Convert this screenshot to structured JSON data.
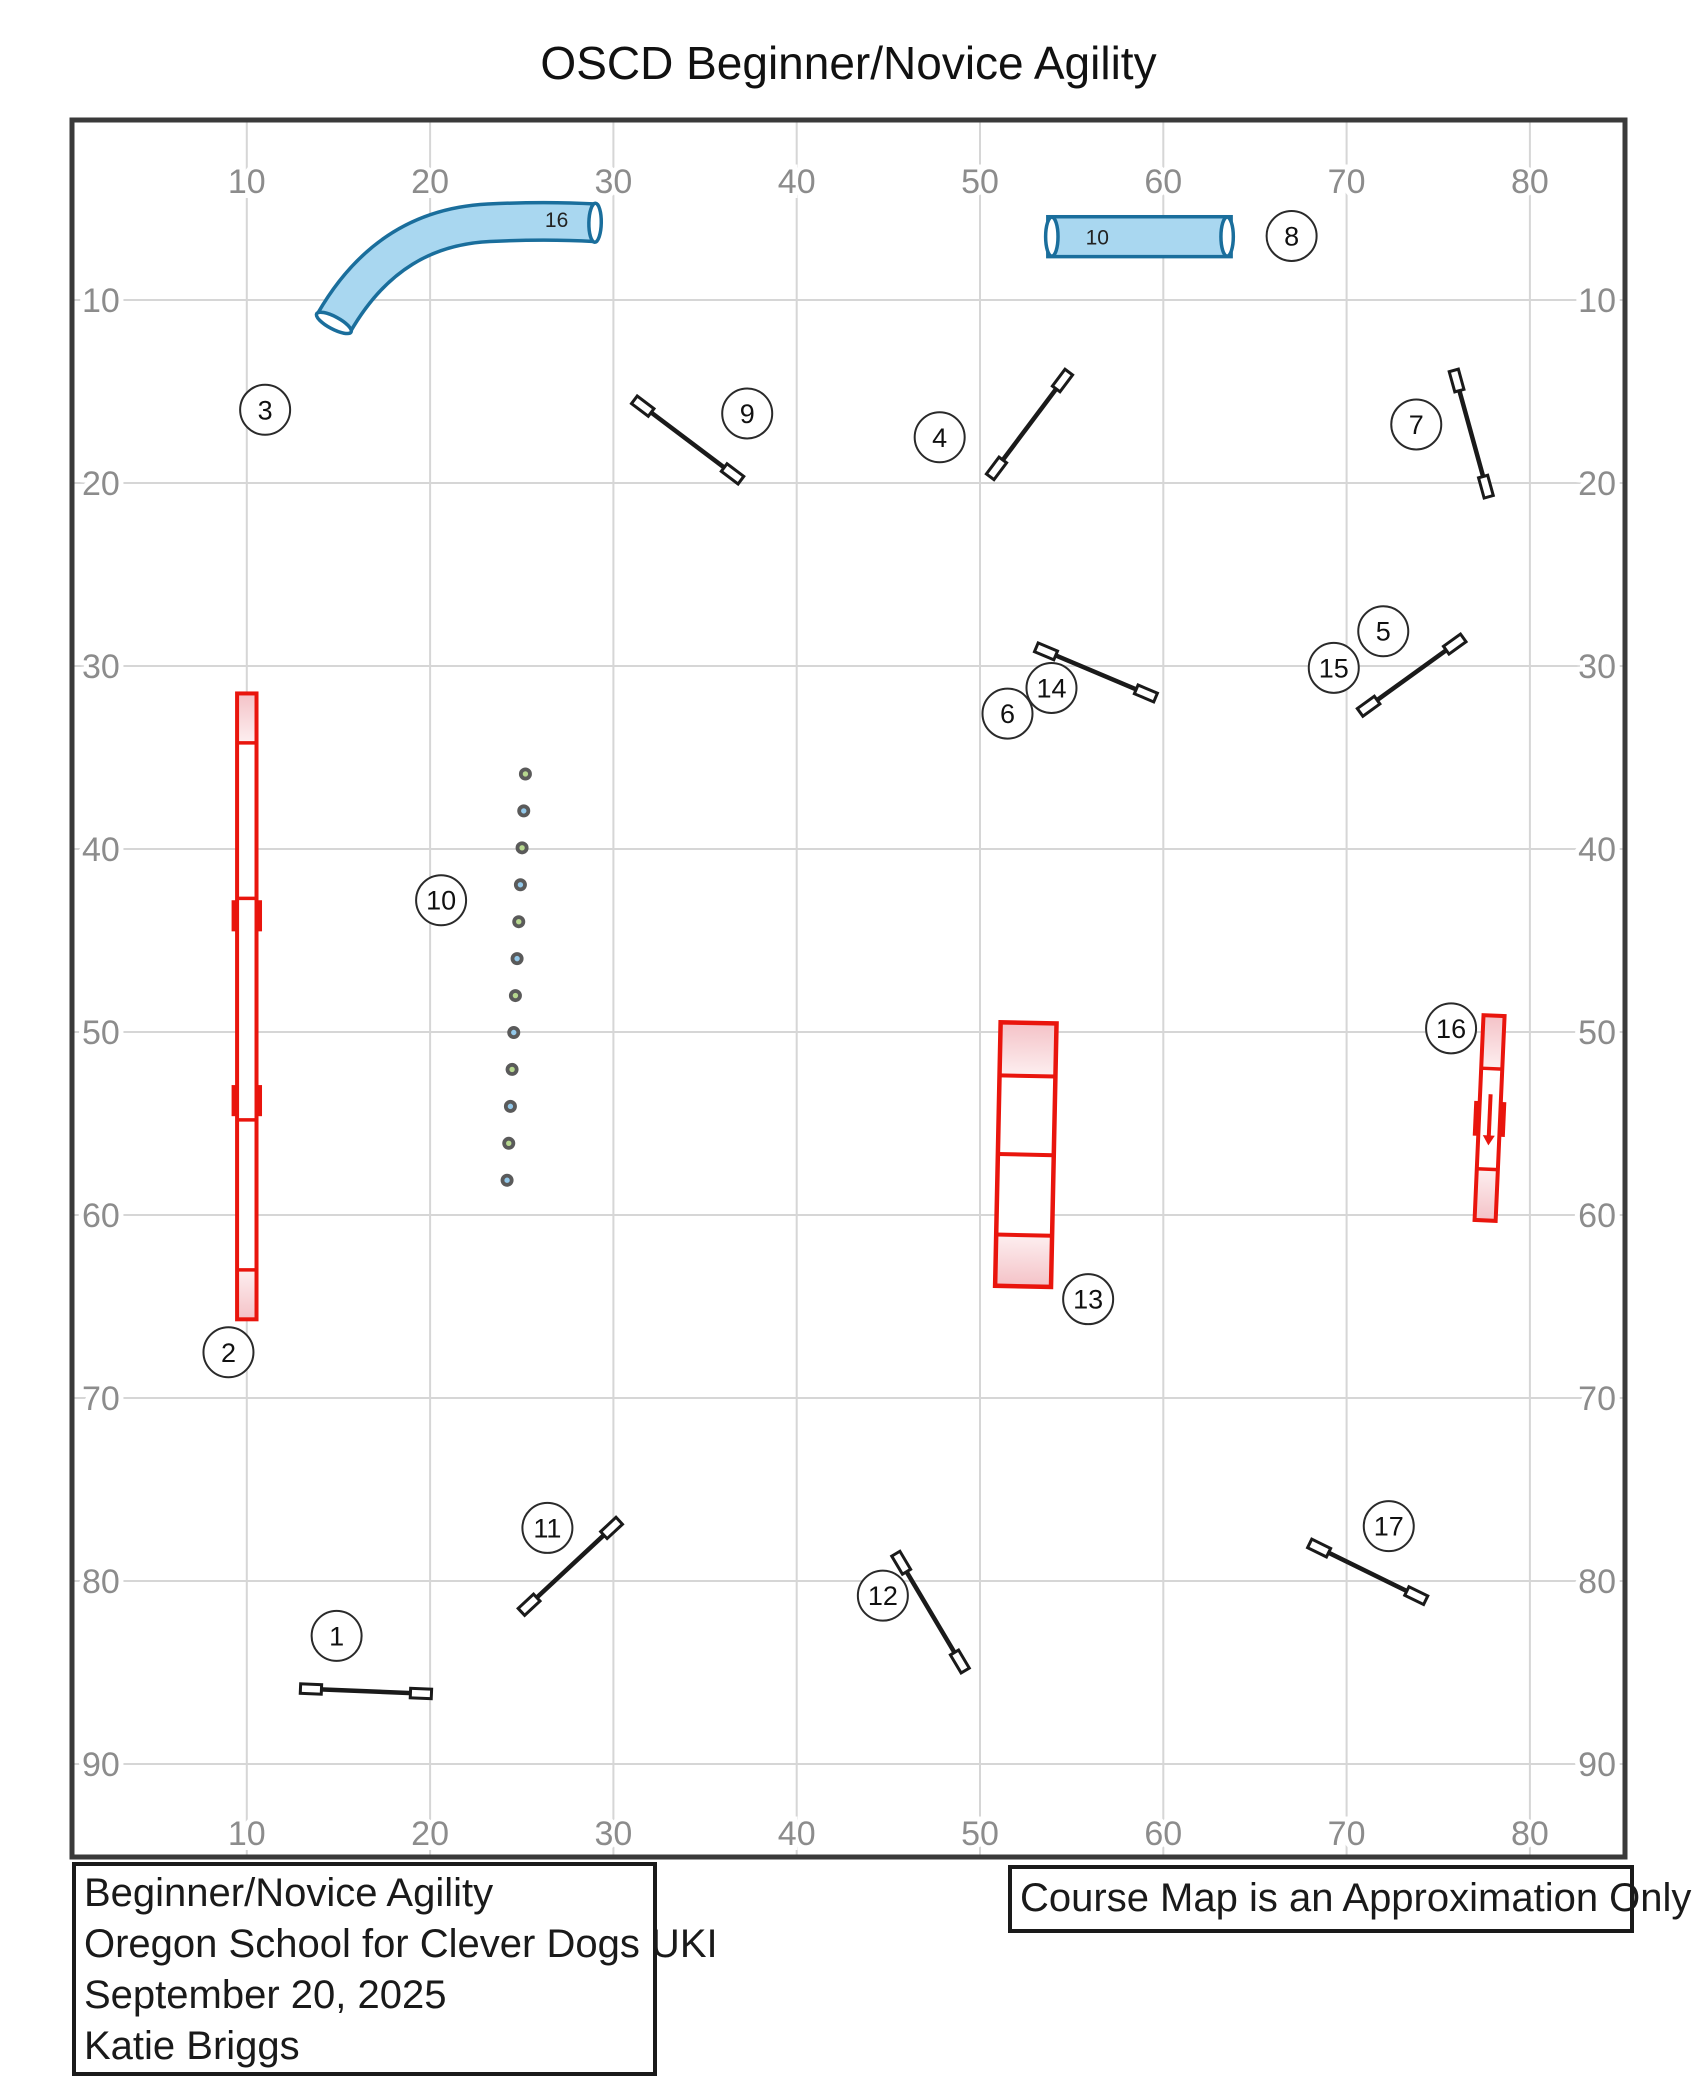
{
  "title": "OSCD Beginner/Novice Agility",
  "note_box": {
    "text": "Course Map is an Approximation Only"
  },
  "info_box": {
    "lines": [
      "Beginner/Novice Agility",
      "Oregon School for Clever Dogs UKI",
      "September 20, 2025",
      "Katie Briggs"
    ]
  },
  "axes": {
    "x_ticks": [
      10,
      20,
      30,
      40,
      50,
      60,
      70,
      80
    ],
    "y_ticks": [
      10,
      20,
      30,
      40,
      50,
      60,
      70,
      80,
      90
    ]
  },
  "colors": {
    "grid": "#d6d6d6",
    "border": "#3a3a3a",
    "tick_label": "#8c8c8c",
    "jump": "#1a1a1a",
    "badge_stroke": "#2a2a2a",
    "badge_text": "#111111",
    "red": "#e9150d",
    "pink_dark": "#f4c2c7",
    "pink_light": "#fdeff0",
    "tunnel_fill": "#a9d7f0",
    "tunnel_stroke": "#1a6e9c",
    "weave_green": "#b6d78e",
    "weave_blue": "#92c8ea",
    "weave_ring": "#5a5a5a",
    "tunnel_label_color": "#222222"
  },
  "course": {
    "jumps": [
      {
        "label": "1",
        "from": [
          13.5,
          85.9
        ],
        "to": [
          19.5,
          86.15
        ]
      },
      {
        "label": "4",
        "from": [
          50.9,
          19.2
        ],
        "to": [
          54.5,
          14.4
        ]
      },
      {
        "label": "5-15",
        "from": [
          71.2,
          32.2
        ],
        "to": [
          75.9,
          28.8
        ]
      },
      {
        "label": "6-14",
        "from": [
          53.6,
          29.2
        ],
        "to": [
          59.05,
          31.5
        ]
      },
      {
        "label": "7",
        "from": [
          76.0,
          14.4
        ],
        "to": [
          77.6,
          20.2
        ]
      },
      {
        "label": "9",
        "from": [
          31.6,
          15.8
        ],
        "to": [
          36.5,
          19.5
        ]
      },
      {
        "label": "11",
        "from": [
          25.4,
          81.3
        ],
        "to": [
          29.9,
          77.1
        ]
      },
      {
        "label": "12",
        "from": [
          45.7,
          79.0
        ],
        "to": [
          48.9,
          84.4
        ]
      },
      {
        "label": "17",
        "from": [
          68.5,
          78.2
        ],
        "to": [
          73.8,
          80.8
        ]
      }
    ],
    "tunnels": [
      {
        "type": "curved",
        "length_label": "16",
        "path": [
          [
            14.75,
            11.25
          ],
          [
            16.9,
            7.5
          ],
          [
            19.8,
            5.95
          ],
          [
            23.2,
            5.78
          ],
          [
            25.6,
            5.66
          ],
          [
            27.6,
            5.7
          ],
          [
            29.0,
            5.78
          ]
        ],
        "mouth_angles": [
          -62,
          1
        ],
        "label_pos": [
          26.9,
          5.62
        ]
      },
      {
        "type": "straight",
        "length_label": "10",
        "from": [
          53.7,
          5.45
        ],
        "to": [
          63.7,
          7.63
        ],
        "label_pos": [
          56.4,
          6.58
        ]
      }
    ],
    "dog_walk": {
      "x_center": 10.0,
      "width": 1.06,
      "top": 31.5,
      "bottom": 65.7,
      "contact_lines": [
        34.2,
        63.0
      ],
      "joints": [
        42.7,
        54.8
      ],
      "tabs": [
        [
          42.8,
          44.5
        ],
        [
          52.9,
          54.6
        ]
      ]
    },
    "a_frame": {
      "x_center": 52.5,
      "width": 3.05,
      "top": 49.5,
      "bottom": 63.9,
      "lines": [
        52.4,
        56.7,
        61.1
      ],
      "tilt_deg": 1.2
    },
    "teeter": {
      "x_center": 77.8,
      "width": 1.15,
      "top": 49.1,
      "bottom": 60.3,
      "lines": [
        52.0,
        57.5
      ],
      "tabs": [
        53.8,
        55.7
      ],
      "arrow": [
        53.4,
        56.2
      ],
      "tilt_deg": 2.5
    },
    "weaves": {
      "count": 12,
      "from": [
        25.2,
        35.9
      ],
      "to": [
        24.2,
        58.1
      ]
    },
    "badges": [
      {
        "n": "1",
        "at": [
          14.9,
          83.0
        ]
      },
      {
        "n": "2",
        "at": [
          9.0,
          67.5
        ]
      },
      {
        "n": "3",
        "at": [
          11.0,
          16.0
        ]
      },
      {
        "n": "4",
        "at": [
          47.8,
          17.5
        ]
      },
      {
        "n": "5",
        "at": [
          72.0,
          28.1
        ]
      },
      {
        "n": "6",
        "at": [
          51.5,
          32.6
        ]
      },
      {
        "n": "7",
        "at": [
          73.8,
          16.8
        ]
      },
      {
        "n": "8",
        "at": [
          67.0,
          6.5
        ]
      },
      {
        "n": "9",
        "at": [
          37.3,
          16.2
        ]
      },
      {
        "n": "10",
        "at": [
          20.6,
          42.8
        ]
      },
      {
        "n": "11",
        "at": [
          26.4,
          77.1
        ]
      },
      {
        "n": "12",
        "at": [
          44.7,
          80.8
        ]
      },
      {
        "n": "13",
        "at": [
          55.9,
          64.6
        ]
      },
      {
        "n": "14",
        "at": [
          53.9,
          31.2
        ]
      },
      {
        "n": "15",
        "at": [
          69.3,
          30.1
        ]
      },
      {
        "n": "16",
        "at": [
          75.7,
          49.8
        ]
      },
      {
        "n": "17",
        "at": [
          72.3,
          77.0
        ]
      }
    ]
  }
}
